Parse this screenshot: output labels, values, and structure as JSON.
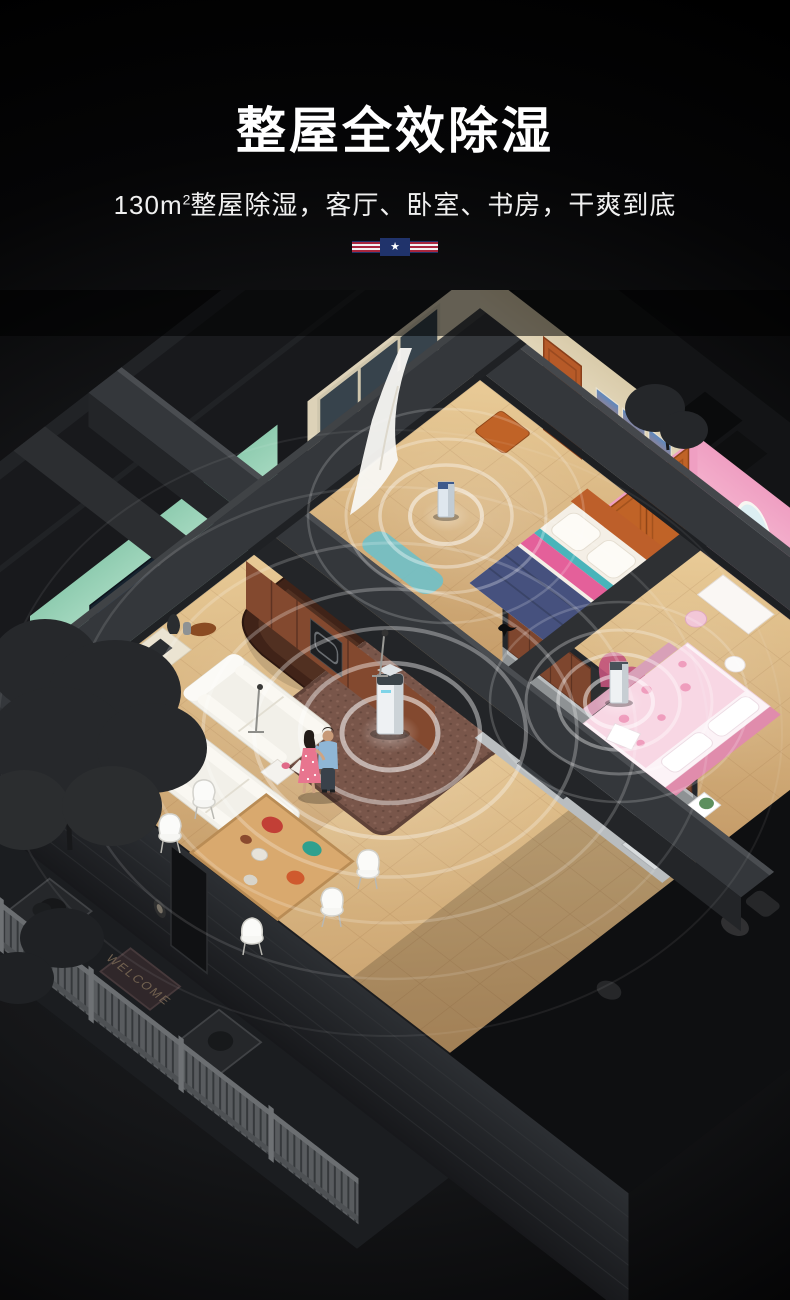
{
  "header": {
    "title": "整屋全效除湿",
    "subtitle": {
      "area_prefix": "130m",
      "area_sup": "2",
      "text": "整屋除湿，客厅、卧室、书房，干爽到底"
    },
    "flag_star": "★"
  },
  "scene": {
    "welcome_mat": "WELCOME"
  },
  "colors": {
    "bg_glow": "#232427",
    "title_color": "#ffffff",
    "subtitle_color": "#f0f0f0",
    "flag_red": "#a8263e",
    "flag_white": "#f2f2f2",
    "flag_navy": "#20336b",
    "mint_light": "#c3e9d5",
    "mint_dark": "#8fccb0",
    "pink_light": "#fbc6da",
    "pink_dark": "#ef9fc2",
    "cream_light": "#f0e7d1",
    "cream_dark": "#d9cbaa",
    "floor_light": "#e9cb97",
    "floor_dark": "#c59c69",
    "carpet": "#79564a",
    "cabinet": "#7e462e",
    "wood_orange": "#c06327",
    "beam": "#34373b",
    "beam_dark": "#232528",
    "ripple": "#ffffff",
    "unit_white": "#eef1f3"
  }
}
